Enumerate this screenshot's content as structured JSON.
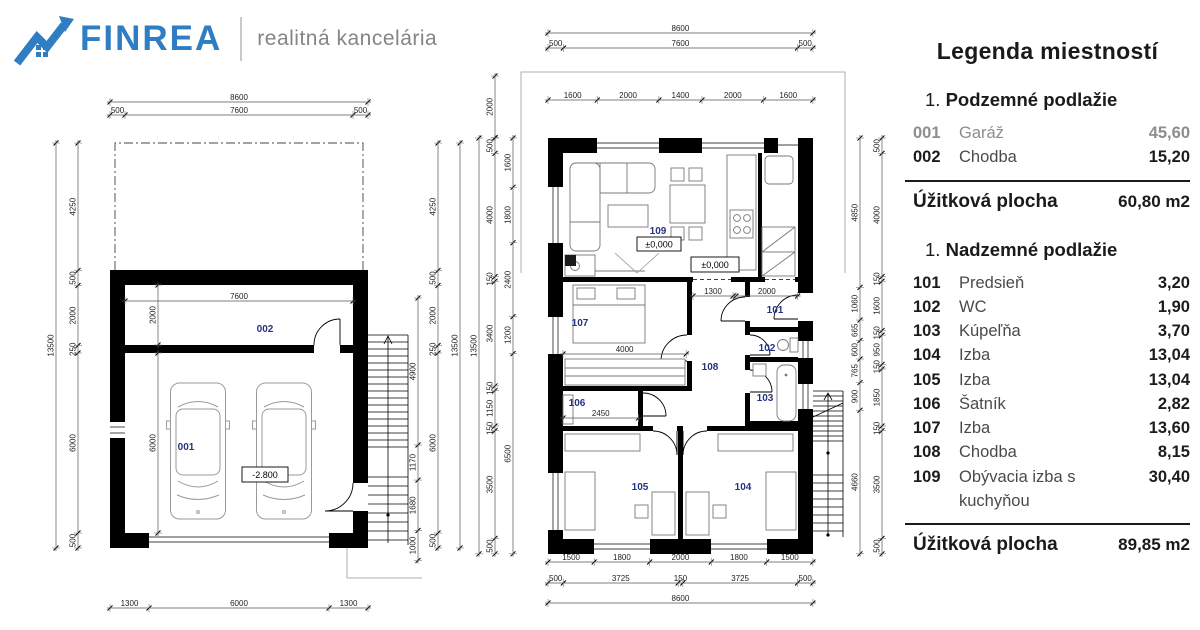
{
  "logo": {
    "brand": "FINREA",
    "tagline": "realitná kancelária",
    "brand_color": "#2f7dc3",
    "tagline_color": "#858585",
    "icon": "house-arrow-icon"
  },
  "legend": {
    "title": "Legenda miestností",
    "sections": [
      {
        "number": "1.",
        "title": "Podzemné podlažie",
        "rows": [
          {
            "code": "001",
            "name": "Garáž",
            "area": "45,60",
            "faded": true
          },
          {
            "code": "002",
            "name": "Chodba",
            "area": "15,20",
            "faded": false
          }
        ],
        "total_label": "Úžitková plocha",
        "total_value": "60,80 m2"
      },
      {
        "number": "1.",
        "title": "Nadzemné podlažie",
        "rows": [
          {
            "code": "101",
            "name": "Predsieň",
            "area": "3,20",
            "faded": false
          },
          {
            "code": "102",
            "name": "WC",
            "area": "1,90",
            "faded": false
          },
          {
            "code": "103",
            "name": "Kúpeľňa",
            "area": "3,70",
            "faded": false
          },
          {
            "code": "104",
            "name": "Izba",
            "area": "13,04",
            "faded": false
          },
          {
            "code": "105",
            "name": "Izba",
            "area": "13,04",
            "faded": false
          },
          {
            "code": "106",
            "name": "Šatník",
            "area": "2,82",
            "faded": false
          },
          {
            "code": "107",
            "name": "Izba",
            "area": "13,60",
            "faded": false
          },
          {
            "code": "108",
            "name": "Chodba",
            "area": "8,15",
            "faded": false
          },
          {
            "code": "109",
            "name": "Obývacia izba s kuchyňou",
            "area": "30,40",
            "faded": false
          }
        ],
        "total_label": "Úžitková plocha",
        "total_value": "89,85 m2"
      }
    ]
  },
  "basement": {
    "room_labels": {
      "r001": "001",
      "r002": "002"
    },
    "elevation": "-2.800",
    "dims": {
      "top_overall": [
        "8600"
      ],
      "top_chain": [
        "500",
        "7600",
        "500"
      ],
      "left_overall": [
        "13500"
      ],
      "left_chain": [
        "4250",
        "500",
        "2000",
        "250",
        "6000",
        "500"
      ],
      "stairs_chain": [
        "4900",
        "1170",
        "1680",
        "1000"
      ],
      "right_chain": [
        "4250",
        "500",
        "2000",
        "250",
        "6000",
        "500"
      ],
      "right_overall": [
        "13500"
      ],
      "bottom_chain": [
        "1300",
        "6000",
        "1300"
      ],
      "corridor_width": [
        "7600"
      ],
      "corridor_height": [
        "2000"
      ],
      "garage_height": [
        "6000"
      ]
    }
  },
  "floor": {
    "room_labels": {
      "r101": "101",
      "r102": "102",
      "r103": "103",
      "r104": "104",
      "r105": "105",
      "r106": "106",
      "r107": "107",
      "r108": "108",
      "r109": "109"
    },
    "elevations": {
      "e0": "±0,000",
      "e1": "±0,000"
    },
    "dims": {
      "top_overall": [
        "8600"
      ],
      "top_chain3": [
        "500",
        "7600",
        "500"
      ],
      "top_chain5": [
        "1600",
        "2000",
        "1400",
        "2000",
        "1600"
      ],
      "left_overall": [
        "13500"
      ],
      "left_top": [
        "2000"
      ],
      "left_chain": [
        "500",
        "4000",
        "150",
        "3400",
        "150",
        "1150",
        "150",
        "3500",
        "500"
      ],
      "left_inner": [
        "1600",
        "1800",
        "2400",
        "1200",
        "6500"
      ],
      "right_inner": [
        "4850",
        "1060",
        "665",
        "600",
        "765",
        "900",
        "4660"
      ],
      "right_chain": [
        "500",
        "4000",
        "150",
        "1600",
        "150",
        "950",
        "150",
        "1850",
        "150",
        "3500",
        "500"
      ],
      "bottom_chain5": [
        "1500",
        "1800",
        "2000",
        "1800",
        "1500"
      ],
      "bottom_chain3": [
        "500",
        "3725",
        "150",
        "3725",
        "500"
      ],
      "bottom_overall": [
        "8600"
      ],
      "hall_width": [
        "1300"
      ],
      "entry_width": [
        "2000"
      ],
      "room107_width": [
        "4000"
      ],
      "room106_width": [
        "2450"
      ]
    }
  }
}
